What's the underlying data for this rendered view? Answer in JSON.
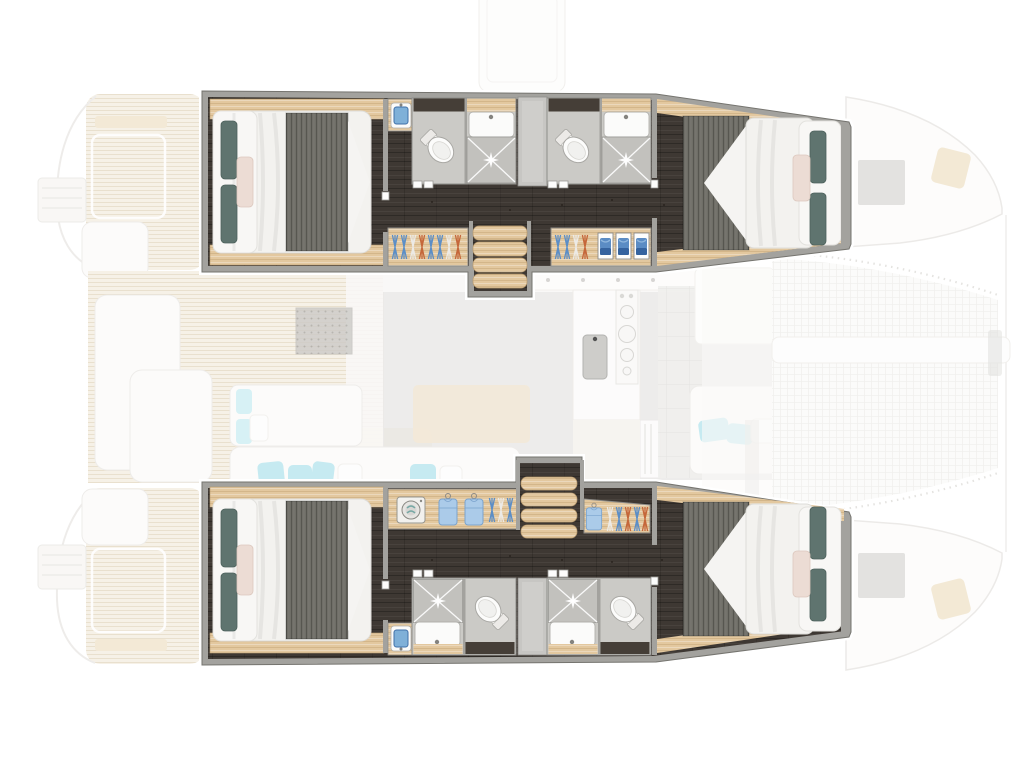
{
  "page": {
    "title": "Catamaran lower-deck floor plan",
    "view": "top-down plan",
    "orientation": {
      "bow": "right",
      "stern": "left"
    },
    "highlight": "hull accommodations shown saturated; main deck shown ghosted"
  },
  "colors": {
    "wall": "#a3a29e",
    "wallLine": "#75746f",
    "floor": "#3e3833",
    "wood": "#e3c89f",
    "duvet": "#f3f2ef",
    "pillowTeal": "#5f746f",
    "pillowBlush": "#ecdcd4",
    "blanket": "#6f6e67",
    "bathFloor": "#cbcac6",
    "showerFloor": "#c2c1bd",
    "fixture": "#fbfbfa",
    "accentBlue": "#5c8ec6",
    "accentBlueDeep": "#35639f",
    "hangerOrange": "#c5673a",
    "ghostDeck": "#f2ebdc",
    "ghostWhite": "#fbfaf8",
    "ghostLine": "#e6e4e0",
    "ghostWood": "#eedfc3",
    "salonFloor": "#dedcd9",
    "aqua": "#ace1ea",
    "grate": "#b3b1ac"
  },
  "plan": {
    "port_hull": {
      "position": "top",
      "rooms": [
        {
          "name": "aft cabin",
          "features": [
            "double bed",
            "teal pillows",
            "blush pillow",
            "dark throw blanket",
            "blue vanity washbasin",
            "wardrobe with hangers"
          ]
        },
        {
          "name": "aft ensuite bathroom",
          "features": [
            "toilet",
            "washbasin",
            "shower with spotlight"
          ]
        },
        {
          "name": "companionway stairs",
          "features": [
            "4 wood treads"
          ]
        },
        {
          "name": "forward ensuite bathroom",
          "features": [
            "toilet",
            "washbasin",
            "shower with spotlight"
          ]
        },
        {
          "name": "forward cabin",
          "features": [
            "double bed",
            "teal pillows",
            "blush pillow",
            "wardrobe with hangers and 3 blue storage bins"
          ]
        }
      ]
    },
    "starboard_hull": {
      "position": "bottom",
      "rooms": [
        {
          "name": "aft cabin",
          "features": [
            "double bed",
            "teal pillows",
            "blush pillow",
            "dark throw blanket",
            "blue vanity washbasin"
          ]
        },
        {
          "name": "wardrobe",
          "features": [
            "washing machine",
            "2 hanging shirts",
            "hangers"
          ]
        },
        {
          "name": "companionway stairs",
          "features": [
            "4 wood treads"
          ]
        },
        {
          "name": "aft ensuite bathroom",
          "features": [
            "shower with spotlight",
            "washbasin",
            "toilet"
          ]
        },
        {
          "name": "forward ensuite bathroom",
          "features": [
            "shower with spotlight",
            "washbasin",
            "toilet"
          ]
        },
        {
          "name": "forward cabin",
          "features": [
            "double bed",
            "teal pillows",
            "blush pillow",
            "wardrobe with shirt and hangers"
          ]
        }
      ]
    },
    "ghosted_deck": {
      "salon": [
        "galley counter",
        "stove with burners",
        "galley sink",
        "fridge",
        "side tiles",
        "chaise with aqua cushions",
        "wood table",
        "aft sofa with aqua cushions",
        "forward seat with aqua cushions",
        "deck grate"
      ],
      "cockpit": [
        "teak plank deck",
        "bench seats",
        "cockpit table",
        "helm seats"
      ],
      "stern": [
        "swim platforms",
        "davit platforms",
        "transom steps"
      ],
      "bow": [
        "trampoline net",
        "lacing stitches",
        "anchor chute",
        "deck hatches",
        "winch pads",
        "boom"
      ]
    }
  }
}
